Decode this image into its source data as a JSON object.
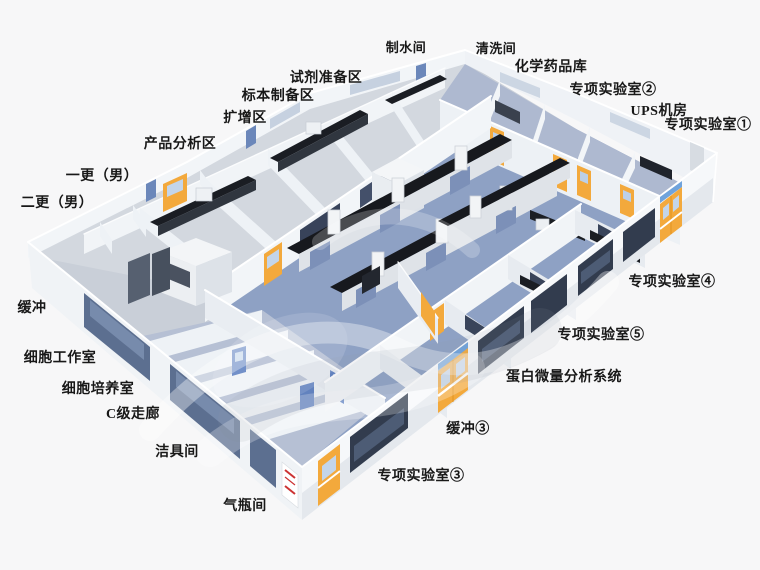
{
  "scene": {
    "description": "3D isometric rendering of a laboratory floor plan with labeled rooms",
    "background": "#f7f7f8"
  },
  "palette": {
    "background": "#f7f7f8",
    "wall_white": "#f3f5f8",
    "wall_shadow": "#dde2e8",
    "floor_blue": "#8ea1c4",
    "floor_blue_light": "#aeb9d0",
    "floor_gray": "#d3d8df",
    "floor_periphery": "#b6c0d4",
    "bench_dark": "#17191e",
    "bench_base": "#e3e7ec",
    "bench_panel_blue": "#7c90b8",
    "door_yellow": "#f3a93c",
    "door_yellow_light": "#ffc95e",
    "door_blue": "#5d80c1",
    "window_dark": "#323c4e",
    "window_blue": "#6f87b0",
    "sign_red": "#cc3333",
    "label_text": "#181818"
  },
  "watermark": {
    "present": true,
    "style": "translucent swirl over center"
  },
  "labels": [
    {
      "id": "water-room",
      "text": "制水间",
      "x": 406,
      "y": 52
    },
    {
      "id": "washing-room",
      "text": "清洗间",
      "x": 496,
      "y": 53
    },
    {
      "id": "chemical-storage",
      "text": "化学药品库",
      "x": 551,
      "y": 71
    },
    {
      "id": "special-lab-2",
      "text": "专项实验室②",
      "x": 613,
      "y": 94
    },
    {
      "id": "ups-room",
      "text": "UPS机房",
      "x": 659,
      "y": 115
    },
    {
      "id": "special-lab-1",
      "text": "专项实验室①",
      "x": 708,
      "y": 129
    },
    {
      "id": "reagent-prep",
      "text": "试剂准备区",
      "x": 326,
      "y": 82
    },
    {
      "id": "specimen-prep",
      "text": "标本制备区",
      "x": 278,
      "y": 100
    },
    {
      "id": "amplification",
      "text": "扩增区",
      "x": 245,
      "y": 122
    },
    {
      "id": "product-analysis",
      "text": "产品分析区",
      "x": 180,
      "y": 148
    },
    {
      "id": "first-change-male",
      "text": "一更（男）",
      "x": 102,
      "y": 180
    },
    {
      "id": "second-change-male",
      "text": "二更（男）",
      "x": 57,
      "y": 207
    },
    {
      "id": "buffer",
      "text": "缓冲",
      "x": 32,
      "y": 312
    },
    {
      "id": "cell-workroom",
      "text": "细胞工作室",
      "x": 60,
      "y": 362
    },
    {
      "id": "cell-culture",
      "text": "细胞培养室",
      "x": 98,
      "y": 393
    },
    {
      "id": "class-c-corridor",
      "text": "C级走廊",
      "x": 133,
      "y": 418
    },
    {
      "id": "cleaning-tool-room",
      "text": "洁具间",
      "x": 177,
      "y": 456
    },
    {
      "id": "gas-cylinder-room",
      "text": "气瓶间",
      "x": 245,
      "y": 510
    },
    {
      "id": "special-lab-3",
      "text": "专项实验室③",
      "x": 421,
      "y": 480
    },
    {
      "id": "buffer-3",
      "text": "缓冲③",
      "x": 468,
      "y": 433
    },
    {
      "id": "protein-micro-analysis",
      "text": "蛋白微量分析系统",
      "x": 564,
      "y": 381
    },
    {
      "id": "special-lab-5",
      "text": "专项实验室⑤",
      "x": 601,
      "y": 339
    },
    {
      "id": "special-lab-4",
      "text": "专项实验室④",
      "x": 672,
      "y": 286
    }
  ]
}
